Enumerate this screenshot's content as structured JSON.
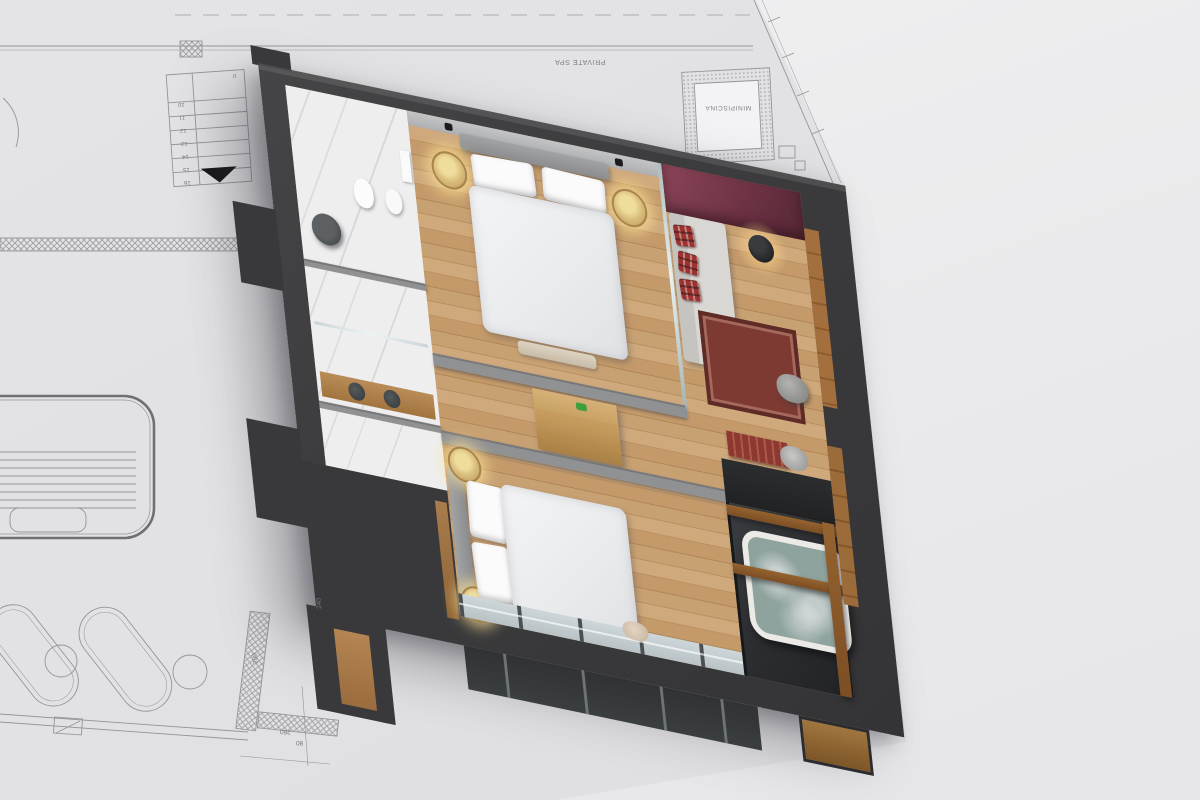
{
  "blueprint": {
    "labels": {
      "private_spa": "PRIVATE SPA",
      "minipiscina": "MINIPISCINA"
    },
    "stair_numbers": [
      "10",
      "11",
      "12",
      "13",
      "14",
      "15",
      "16"
    ],
    "stair_start_label": "0",
    "dimensions": {
      "d1": "200",
      "d2": "240",
      "d3": "260",
      "d4": "80"
    }
  },
  "colors": {
    "background": "#eaeaec",
    "paper": "#e2e2e4",
    "blueprint_line": "#96979b",
    "wall_dark": "#3c3c3e",
    "wood_floor": "#c29a6c",
    "wood_beam": "#8a5a33",
    "marble": "#eeeeef",
    "accent_burgundy": "#7c3b4d",
    "terrace_dark": "#2c2e30",
    "bedding_white": "#eff1f2",
    "glass": "#c3cdd0",
    "rug_red": "#7c3a33",
    "lamp_glow": "#f5df9e"
  }
}
